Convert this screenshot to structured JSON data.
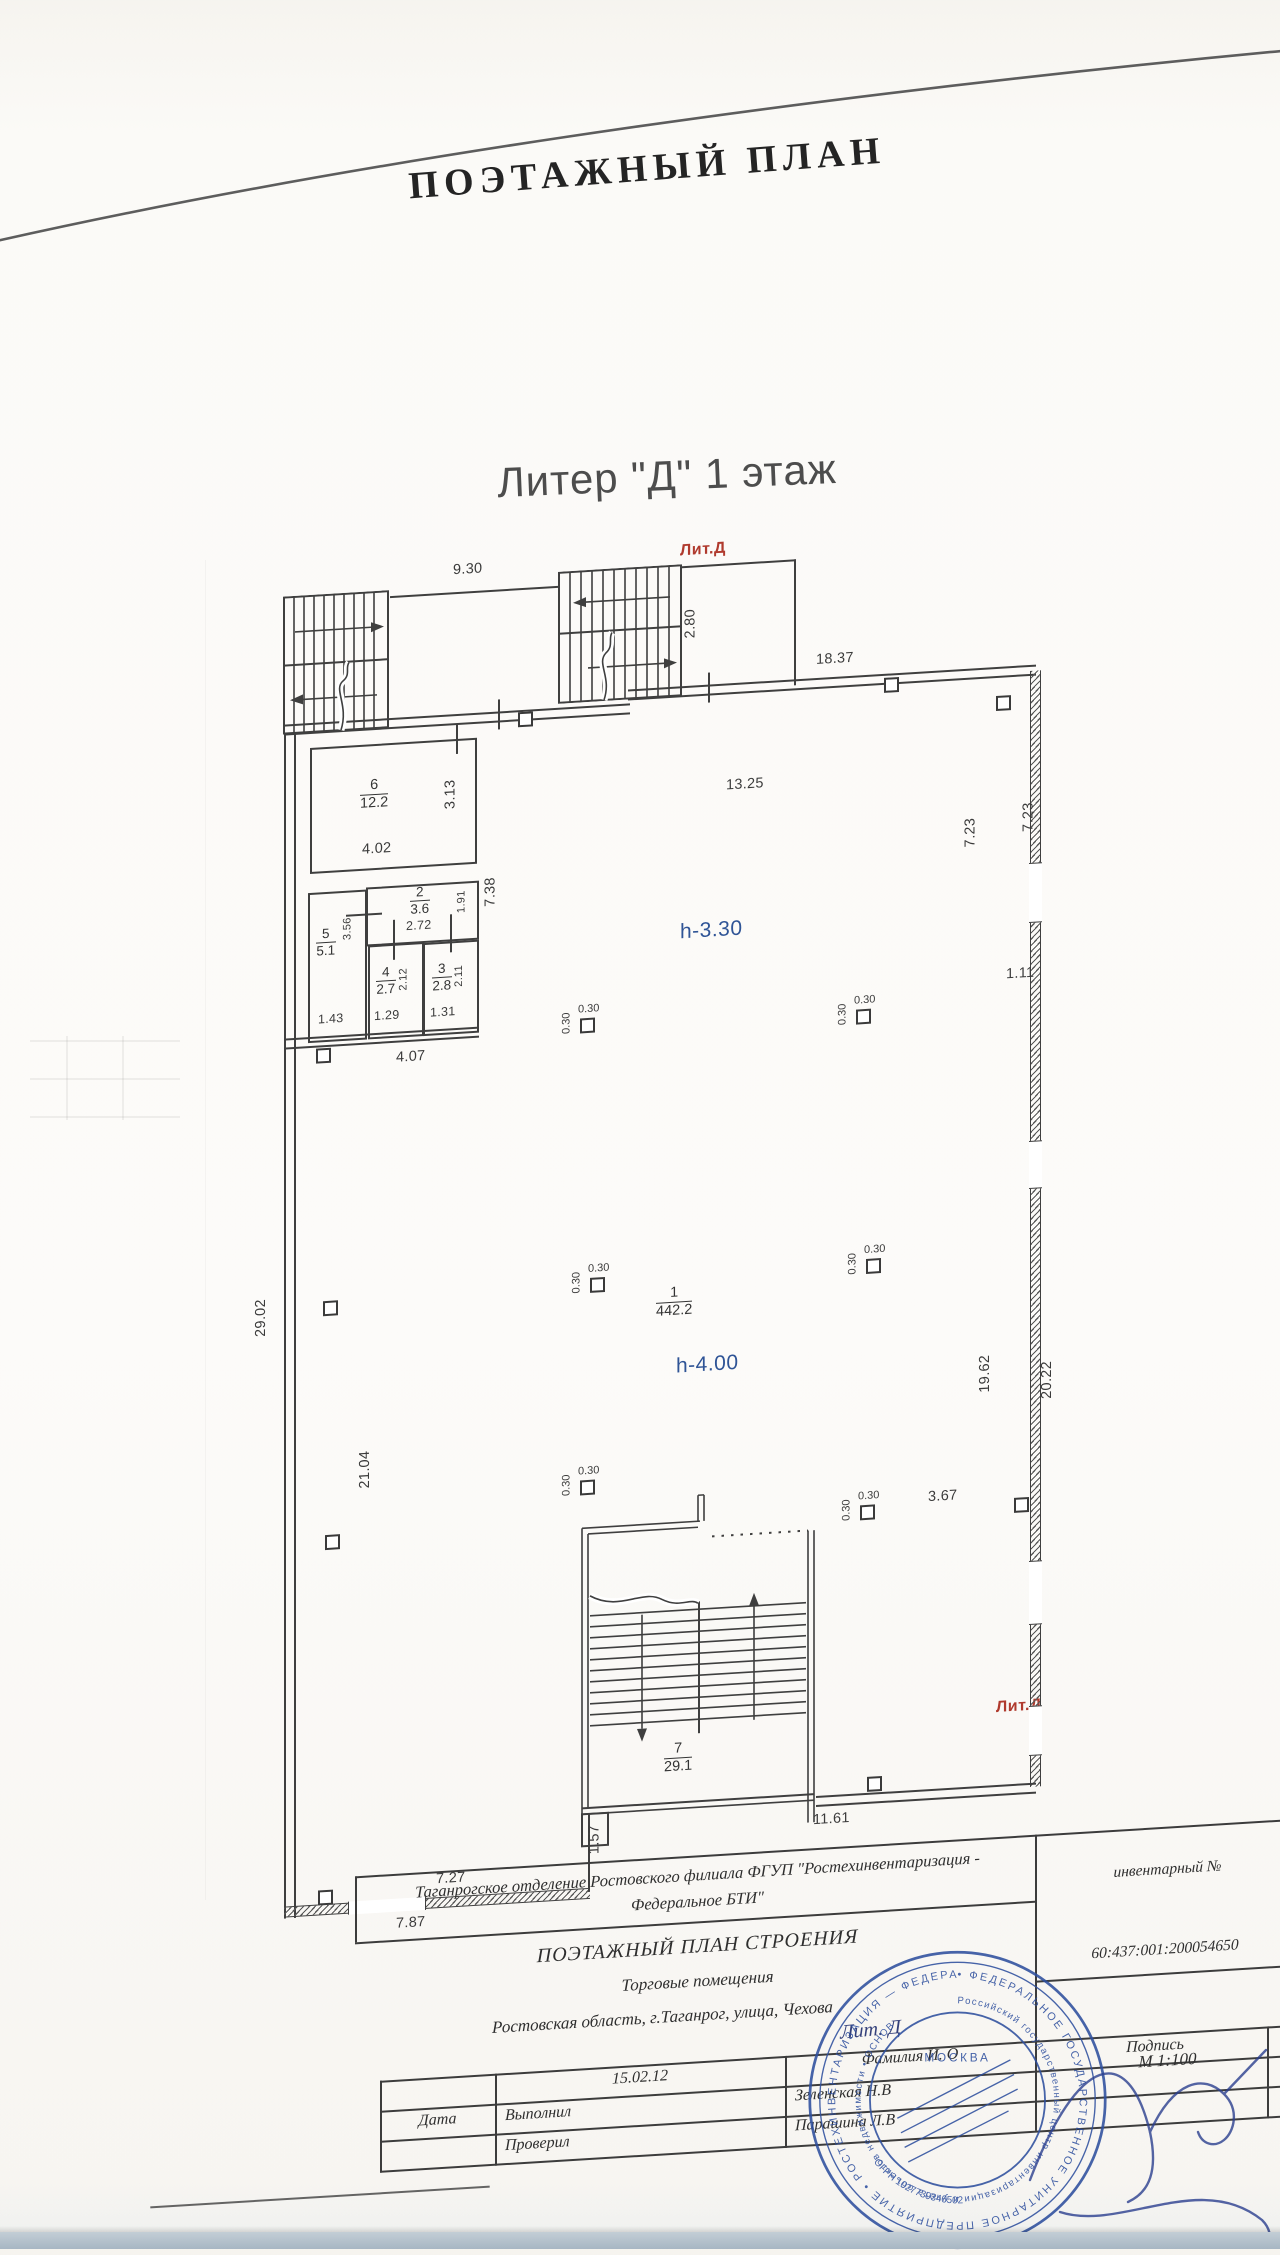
{
  "page": {
    "title": "ПОЭТАЖНЫЙ ПЛАН",
    "subtitle": "Литер \"Д\" 1 этаж"
  },
  "plan": {
    "lit_label_top": "Лит.Д",
    "lit_label_bottom": "Лит.Д",
    "col_label": "0.30",
    "heights": {
      "hall_upper": "h-3.30",
      "hall_main": "h-4.00"
    },
    "rooms": {
      "r1": {
        "num": "1",
        "area": "442.2"
      },
      "r2": {
        "num": "2",
        "area": "3.6"
      },
      "r3": {
        "num": "3",
        "area": "2.8"
      },
      "r4": {
        "num": "4",
        "area": "2.7"
      },
      "r5": {
        "num": "5",
        "area": "5.1"
      },
      "r6": {
        "num": "6",
        "area": "12.2"
      },
      "r7": {
        "num": "7",
        "area": "29.1"
      }
    },
    "dims": {
      "top_stairs": "9.30",
      "stair_depth": "2.80",
      "top_wall": "18.37",
      "hall_width": "13.25",
      "room6_h": "3.13",
      "room6_w": "4.02",
      "corridor": "7.38",
      "room2_w": "2.72",
      "room2_h": "1.91",
      "room5_h": "3.56",
      "room4_h": "2.12",
      "room3_h": "2.11",
      "room5_w": "1.43",
      "room4_w": "1.29",
      "room3_w": "1.31",
      "rooms_bottom": "4.07",
      "right_upper_in": "7.23",
      "right_upper_out": "7.23",
      "right_step": "1.11",
      "left_total": "29.02",
      "left_lower": "21.04",
      "right_lower_in": "19.62",
      "right_lower_out": "20.22",
      "col_span": "3.67",
      "bottom_step": "1.57",
      "bottom_right": "11.61",
      "bottom_left_in": "7.27",
      "bottom_left_out": "7.87"
    }
  },
  "titleblock": {
    "org_line1": "Таганрогское отделение Ростовского филиала ФГУП \"Ростехинвентаризация -",
    "org_line2": "Федеральное БТИ\"",
    "doc_title": "ПОЭТАЖНЫЙ ПЛАН СТРОЕНИЯ",
    "usage": "Торговые помещения",
    "address": "Ростовская область, г.Таганрог, улица, Чехова",
    "inventory_label": "инвентарный №",
    "inventory_number": "60:437:001:200054650",
    "scale": "М 1:100",
    "date_value": "15.02.12",
    "row_date": "Дата",
    "row_made": "Выполнил",
    "row_checked": "Проверил",
    "name_header": "Фамилия И. О",
    "name_made": "Зеленская Н.В",
    "name_checked": "Парашина Л.В",
    "signature_label": "Подпись",
    "handwritten_lit": "Лит. Д"
  },
  "stamp": {
    "ring_text": "• ФЕДЕРАЛЬНОЕ ГОСУДАРСТВЕННОЕ УНИТАРНОЕ ПРЕДПРИЯТИЕ • РОСТЕХИНВЕНТАРИЗАЦИЯ — ФЕДЕРАЛЬНОЕ БТИ",
    "ring2_text": "Российский государственный центр инвентаризации и учета объектов недвижимости • ОСНОВ",
    "city": "МОСКВА",
    "ogrn": "ОГРН 1027739346502"
  },
  "colors": {
    "ink": "#3f3f3f",
    "red": "#b03a2e",
    "blue_height": "#2f5496",
    "stamp": "#2e4f9e"
  }
}
